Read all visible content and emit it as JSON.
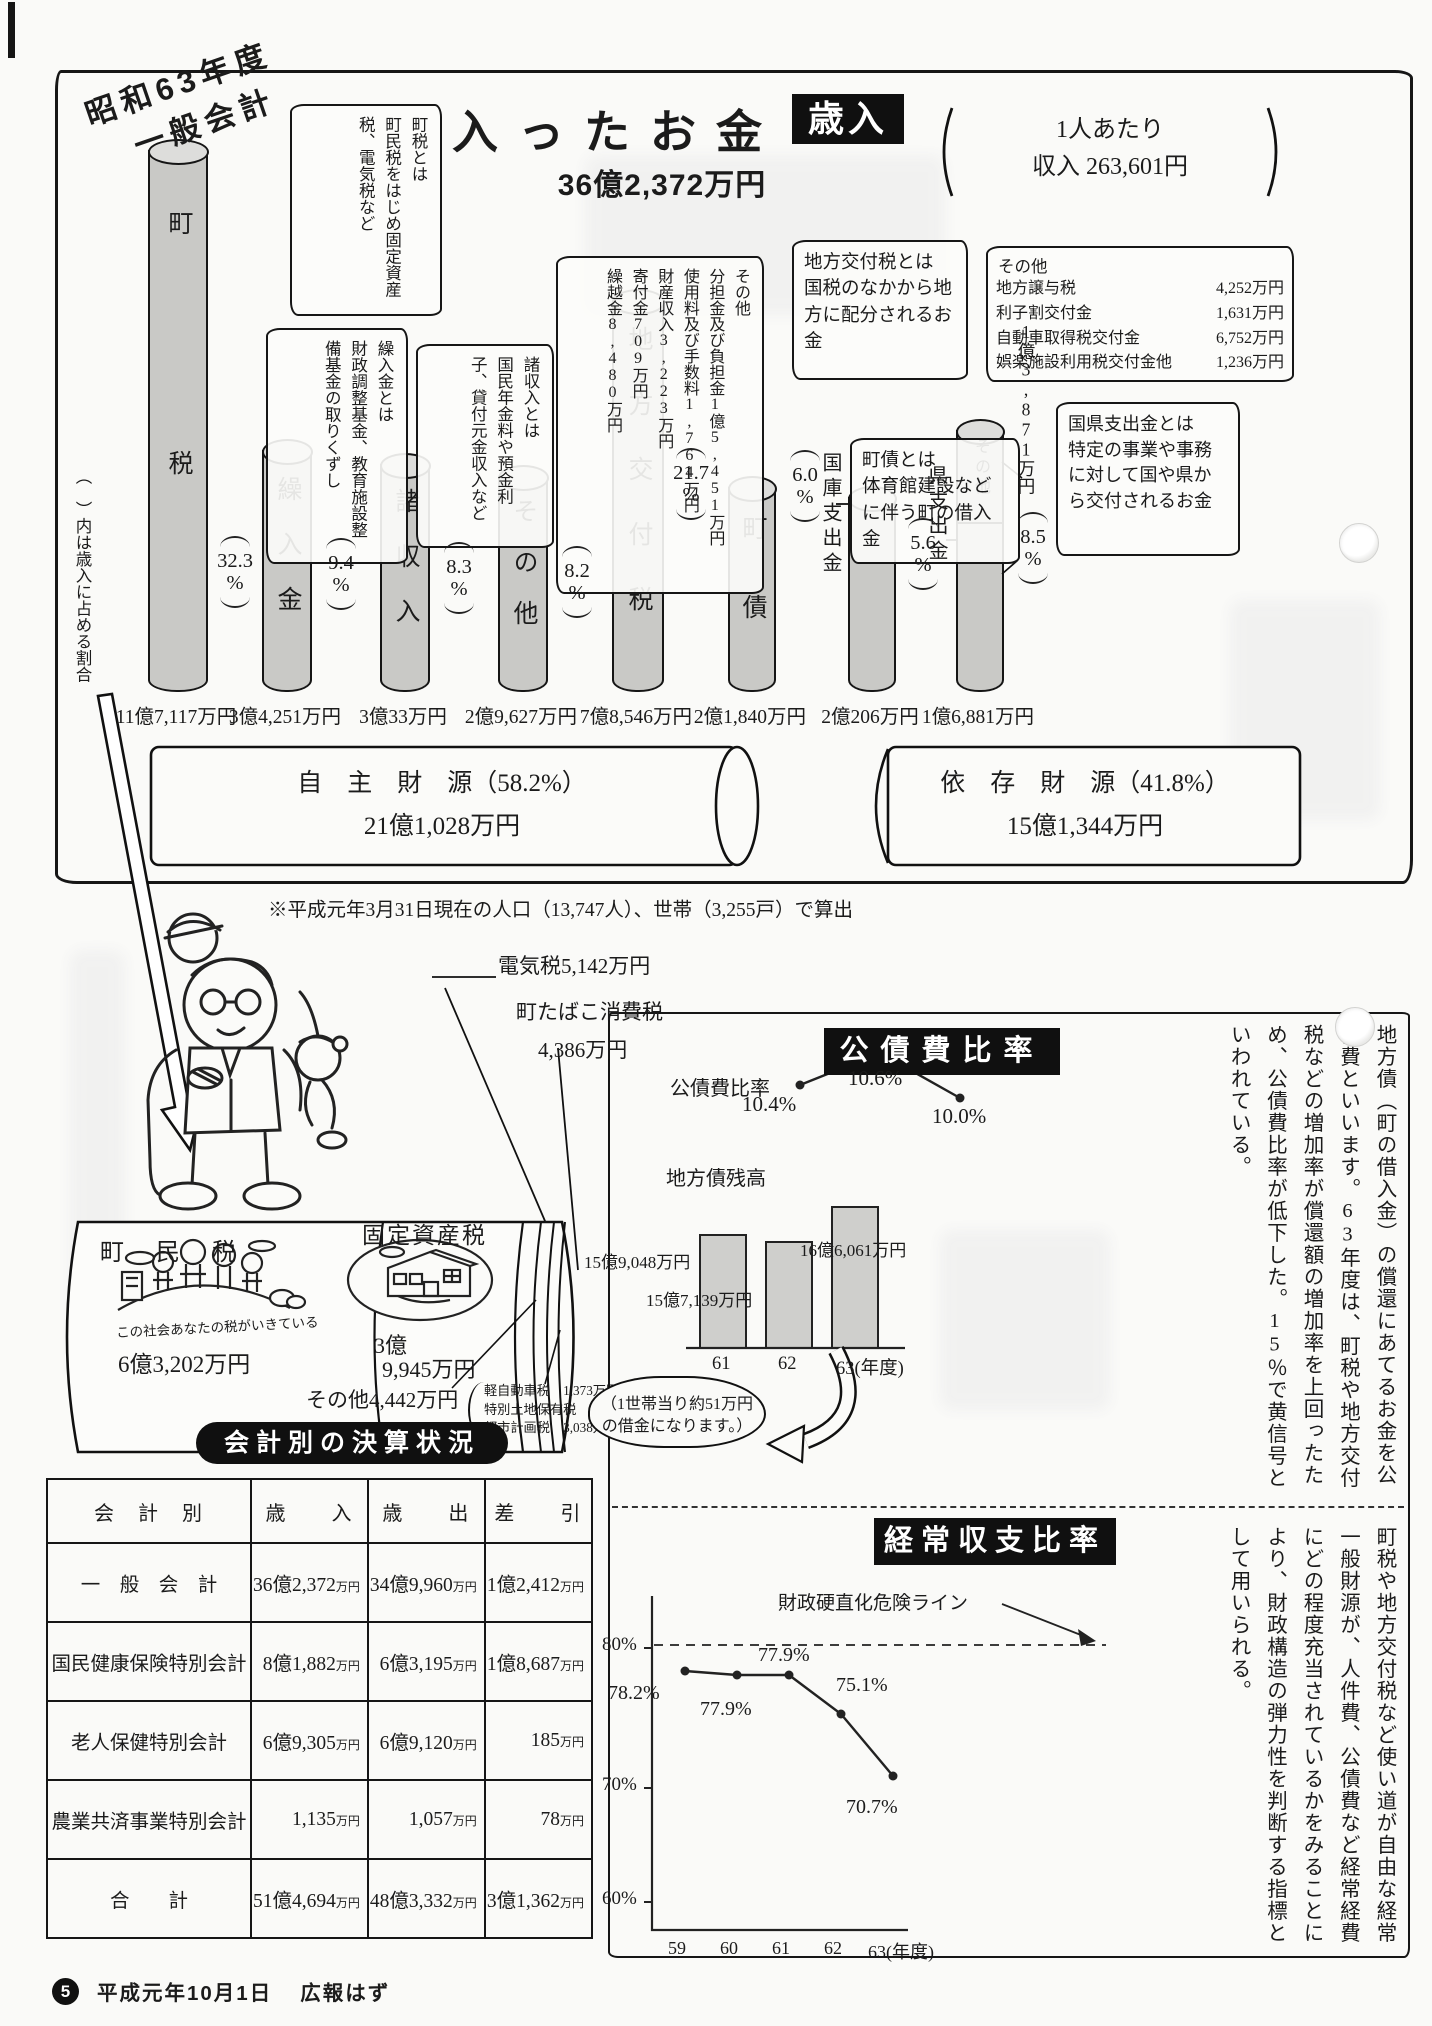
{
  "misc": {
    "percent": "%",
    "manyen": "万円"
  },
  "header": {
    "era_line1": "昭和63年度",
    "era_line2": "一般会計",
    "title": "入ったお金",
    "badge": "歳入",
    "total": "36億2,372万円",
    "per_capita_line1": "1人あたり",
    "per_capita_line2": "収入 263,601円"
  },
  "notes": {
    "chozei_title": "町税とは",
    "chozei_body": "町民税をはじめ固定資産税、電気税など",
    "kuriire_title": "繰入金とは",
    "kuriire_body": "財政調整基金、教育施設整備基金の取りくずし",
    "shoshunyu_title": "諸収入とは",
    "shoshunyu_body": "国民年金料や預金利子、貸付元金収入など",
    "sonota_title": "その他",
    "sonota_item1": "分担金及び負担金1億5,451万円",
    "sonota_item2": "使用料及び手数料1,764万円",
    "sonota_item3": "財産収入3,223万円",
    "sonota_item4": "寄付金709万円",
    "sonota_item5": "繰越金8,480万円",
    "kofuzei_title": "地方交付税とは",
    "kofuzei_body": "国税のなかから地方に配分されるお金",
    "sonota2_title": "その他",
    "sonota2_rows": [
      {
        "name": "地方譲与税",
        "value": "4,252万円"
      },
      {
        "name": "利子割交付金",
        "value": "1,631万円"
      },
      {
        "name": "自動車取得税交付金",
        "value": "6,752万円"
      },
      {
        "name": "娯楽施設利用税交付金他",
        "value": "1,236万円"
      }
    ],
    "chosai_title": "町債とは",
    "chosai_body": "体育館建設などに伴う町の借入金",
    "kokken_title": "国県支出金とは",
    "kokken_body": "特定の事業や事務に対して国や県から交付されるお金",
    "axis_note": "（　）内は歳入に占める割合"
  },
  "bars": [
    {
      "label": "町税",
      "pct": "32.3",
      "amount": "11億7,117万円"
    },
    {
      "label": "繰入金",
      "pct": "9.4",
      "amount": "3億4,251万円"
    },
    {
      "label": "諸収入",
      "pct": "8.3",
      "amount": "3億33万円"
    },
    {
      "label": "その他",
      "pct": "8.2",
      "amount": "2億9,627万円"
    },
    {
      "label": "地方交付税",
      "pct": "21.7",
      "amount": "7億8,546万円"
    },
    {
      "label": "町債",
      "pct": "6.0",
      "amount": "2億1,840万円"
    },
    {
      "label": "国庫支出金",
      "pct": "5.6",
      "amount": "2億206万円"
    },
    {
      "label": "県支出金",
      "pct": "8.5",
      "amount": "1億6,881万円",
      "top_label": "その他",
      "top_amount": "1億3,871万円"
    }
  ],
  "sources": {
    "jishu_label": "自　主　財　源（58.2%）",
    "jishu_amount": "21億1,028万円",
    "izon_label": "依　存　財　源（41.8%）",
    "izon_amount": "15億1,344万円"
  },
  "footnote": "※平成元年3月31日現在の人口（13,747人）、世帯（3,255戸）で算出",
  "tax_cyl": {
    "denkizei": "電気税5,142万円",
    "tabako1": "町たばこ消費税",
    "tabako2": "4,386万円",
    "chominzei": "町　民　税",
    "slogan": "この社会あなたの税がいきている",
    "chominzei_amount": "6億3,202万円",
    "kotei": "固定資産税",
    "kotei_amount1": "3億",
    "kotei_amount2": "9,945万円",
    "sonota": "その他4,442万円",
    "bd1": "軽自動車税　1,373万円",
    "bd2": "特別土地保有税　31万円",
    "bd3": "都市計画税　3,038万円"
  },
  "kosaihi": {
    "header": "公債費比率",
    "line_label": "公債費比率",
    "pt1": "10.4%",
    "pt2": "10.6%",
    "pt3": "10.0%",
    "bond_label": "地方債残高",
    "bond_v1": "15億9,048万円",
    "bond_v2": "15億7,139万円",
    "bond_v3": "16億6,061万円",
    "year1": "61",
    "year2": "62",
    "year3": "63(年度)",
    "oval1": "（1世帯当り約51万円",
    "oval2": "の借金になります。）",
    "body": "地方債（町の借入金）の償還にあてるお金を公債費といいます。63年度は、町税や地方交付税などの増加率が償還額の増加率を上回ったため、公債費比率が低下した。15％で黄信号といわれている。"
  },
  "keijo": {
    "header": "経常収支比率",
    "danger": "財政硬直化危険ライン",
    "y1": "80%",
    "y2": "70%",
    "y3": "60%",
    "x1": "59",
    "x2": "60",
    "x3": "61",
    "x4": "62",
    "x5": "63(年度)",
    "p1": "78.2%",
    "p2": "77.9%",
    "p3": "77.9%",
    "p4": "75.1%",
    "p5": "70.7%",
    "body": "町税や地方交付税など使い道が自由な経常一般財源が、人件費、公債費など経常経費にどの程度充当されているかをみることにより、財政構造の弾力性を判断する指標として用いられる。"
  },
  "table": {
    "title": "会計別の決算状況",
    "h1": "会　計　別",
    "h2": "歳　　入",
    "h3": "歳　　出",
    "h4": "差　　引",
    "rows": [
      {
        "label": "一　般　会　計",
        "in": "36億2,372",
        "out": "34億9,960",
        "diff": "1億2,412"
      },
      {
        "label": "国民健康保険特別会計",
        "in": "8億1,882",
        "out": "6億3,195",
        "diff": "1億8,687"
      },
      {
        "label": "老人保健特別会計",
        "in": "6億9,305",
        "out": "6億9,120",
        "diff": "185"
      },
      {
        "label": "農業共済事業特別会計",
        "in": "1,135",
        "out": "1,057",
        "diff": "78"
      },
      {
        "label": "合　　計",
        "in": "51億4,694",
        "out": "48億3,332",
        "diff": "3億1,362"
      }
    ]
  },
  "footer": {
    "page": "5",
    "date": "平成元年10月1日",
    "name": "広報はず"
  },
  "chart_data": [
    {
      "type": "bar",
      "title": "歳入の内訳（昭和63年度一般会計）合計36億2,372万円",
      "categories": [
        "町税",
        "繰入金",
        "諸収入",
        "その他",
        "地方交付税",
        "町債",
        "国庫支出金",
        "県支出金",
        "県支出金上乗せその他"
      ],
      "series": [
        {
          "name": "構成比(%)",
          "values": [
            32.3,
            9.4,
            8.3,
            8.2,
            21.7,
            6.0,
            5.6,
            8.5,
            null
          ]
        },
        {
          "name": "金額(万円)",
          "values": [
            117117,
            34251,
            30033,
            29627,
            78546,
            21840,
            20206,
            16881,
            13871
          ]
        }
      ],
      "groups": [
        {
          "name": "自主財源",
          "pct": 58.2,
          "amount_manen": 211028
        },
        {
          "name": "依存財源",
          "pct": 41.8,
          "amount_manen": 151344
        }
      ],
      "per_capita_yen": 263601,
      "population": 13747,
      "households": 3255
    },
    {
      "type": "line",
      "title": "公債費比率",
      "x": [
        "61",
        "62",
        "63"
      ],
      "values": [
        10.4,
        10.6,
        10.0
      ],
      "unit": "%"
    },
    {
      "type": "bar",
      "title": "地方債残高",
      "x": [
        "61",
        "62",
        "63"
      ],
      "values_manen": [
        159048,
        157139,
        166061
      ],
      "labels": [
        "15億9,048万円",
        "15億7,139万円",
        "16億6,061万円"
      ],
      "note": "1世帯当り約51万円の借金になります。"
    },
    {
      "type": "line",
      "title": "経常収支比率",
      "x": [
        "59",
        "60",
        "61",
        "62",
        "63"
      ],
      "values": [
        78.2,
        77.9,
        77.9,
        75.1,
        70.7
      ],
      "ylim": [
        60,
        80
      ],
      "danger_line": {
        "value": 80,
        "label": "財政硬直化危険ライン"
      },
      "unit": "%"
    },
    {
      "type": "table",
      "title": "会計別の決算状況",
      "columns": [
        "会計別",
        "歳入(万円)",
        "歳出(万円)",
        "差引(万円)"
      ],
      "rows": [
        [
          "一般会計",
          362372,
          349960,
          12412
        ],
        [
          "国民健康保険特別会計",
          81882,
          63195,
          18687
        ],
        [
          "老人保健特別会計",
          69305,
          69120,
          185
        ],
        [
          "農業共済事業特別会計",
          1135,
          1057,
          78
        ],
        [
          "合計",
          514694,
          483332,
          31362
        ]
      ]
    },
    {
      "type": "bar",
      "title": "町税の内訳",
      "categories": [
        "町民税",
        "固定資産税",
        "電気税",
        "町たばこ消費税",
        "その他"
      ],
      "values_manen": [
        63202,
        39945,
        5142,
        4386,
        4442
      ],
      "sonota_breakdown": [
        {
          "name": "軽自動車税",
          "value_manen": 1373
        },
        {
          "name": "特別土地保有税",
          "value_manen": 31
        },
        {
          "name": "都市計画税",
          "value_manen": 3038
        }
      ]
    }
  ]
}
